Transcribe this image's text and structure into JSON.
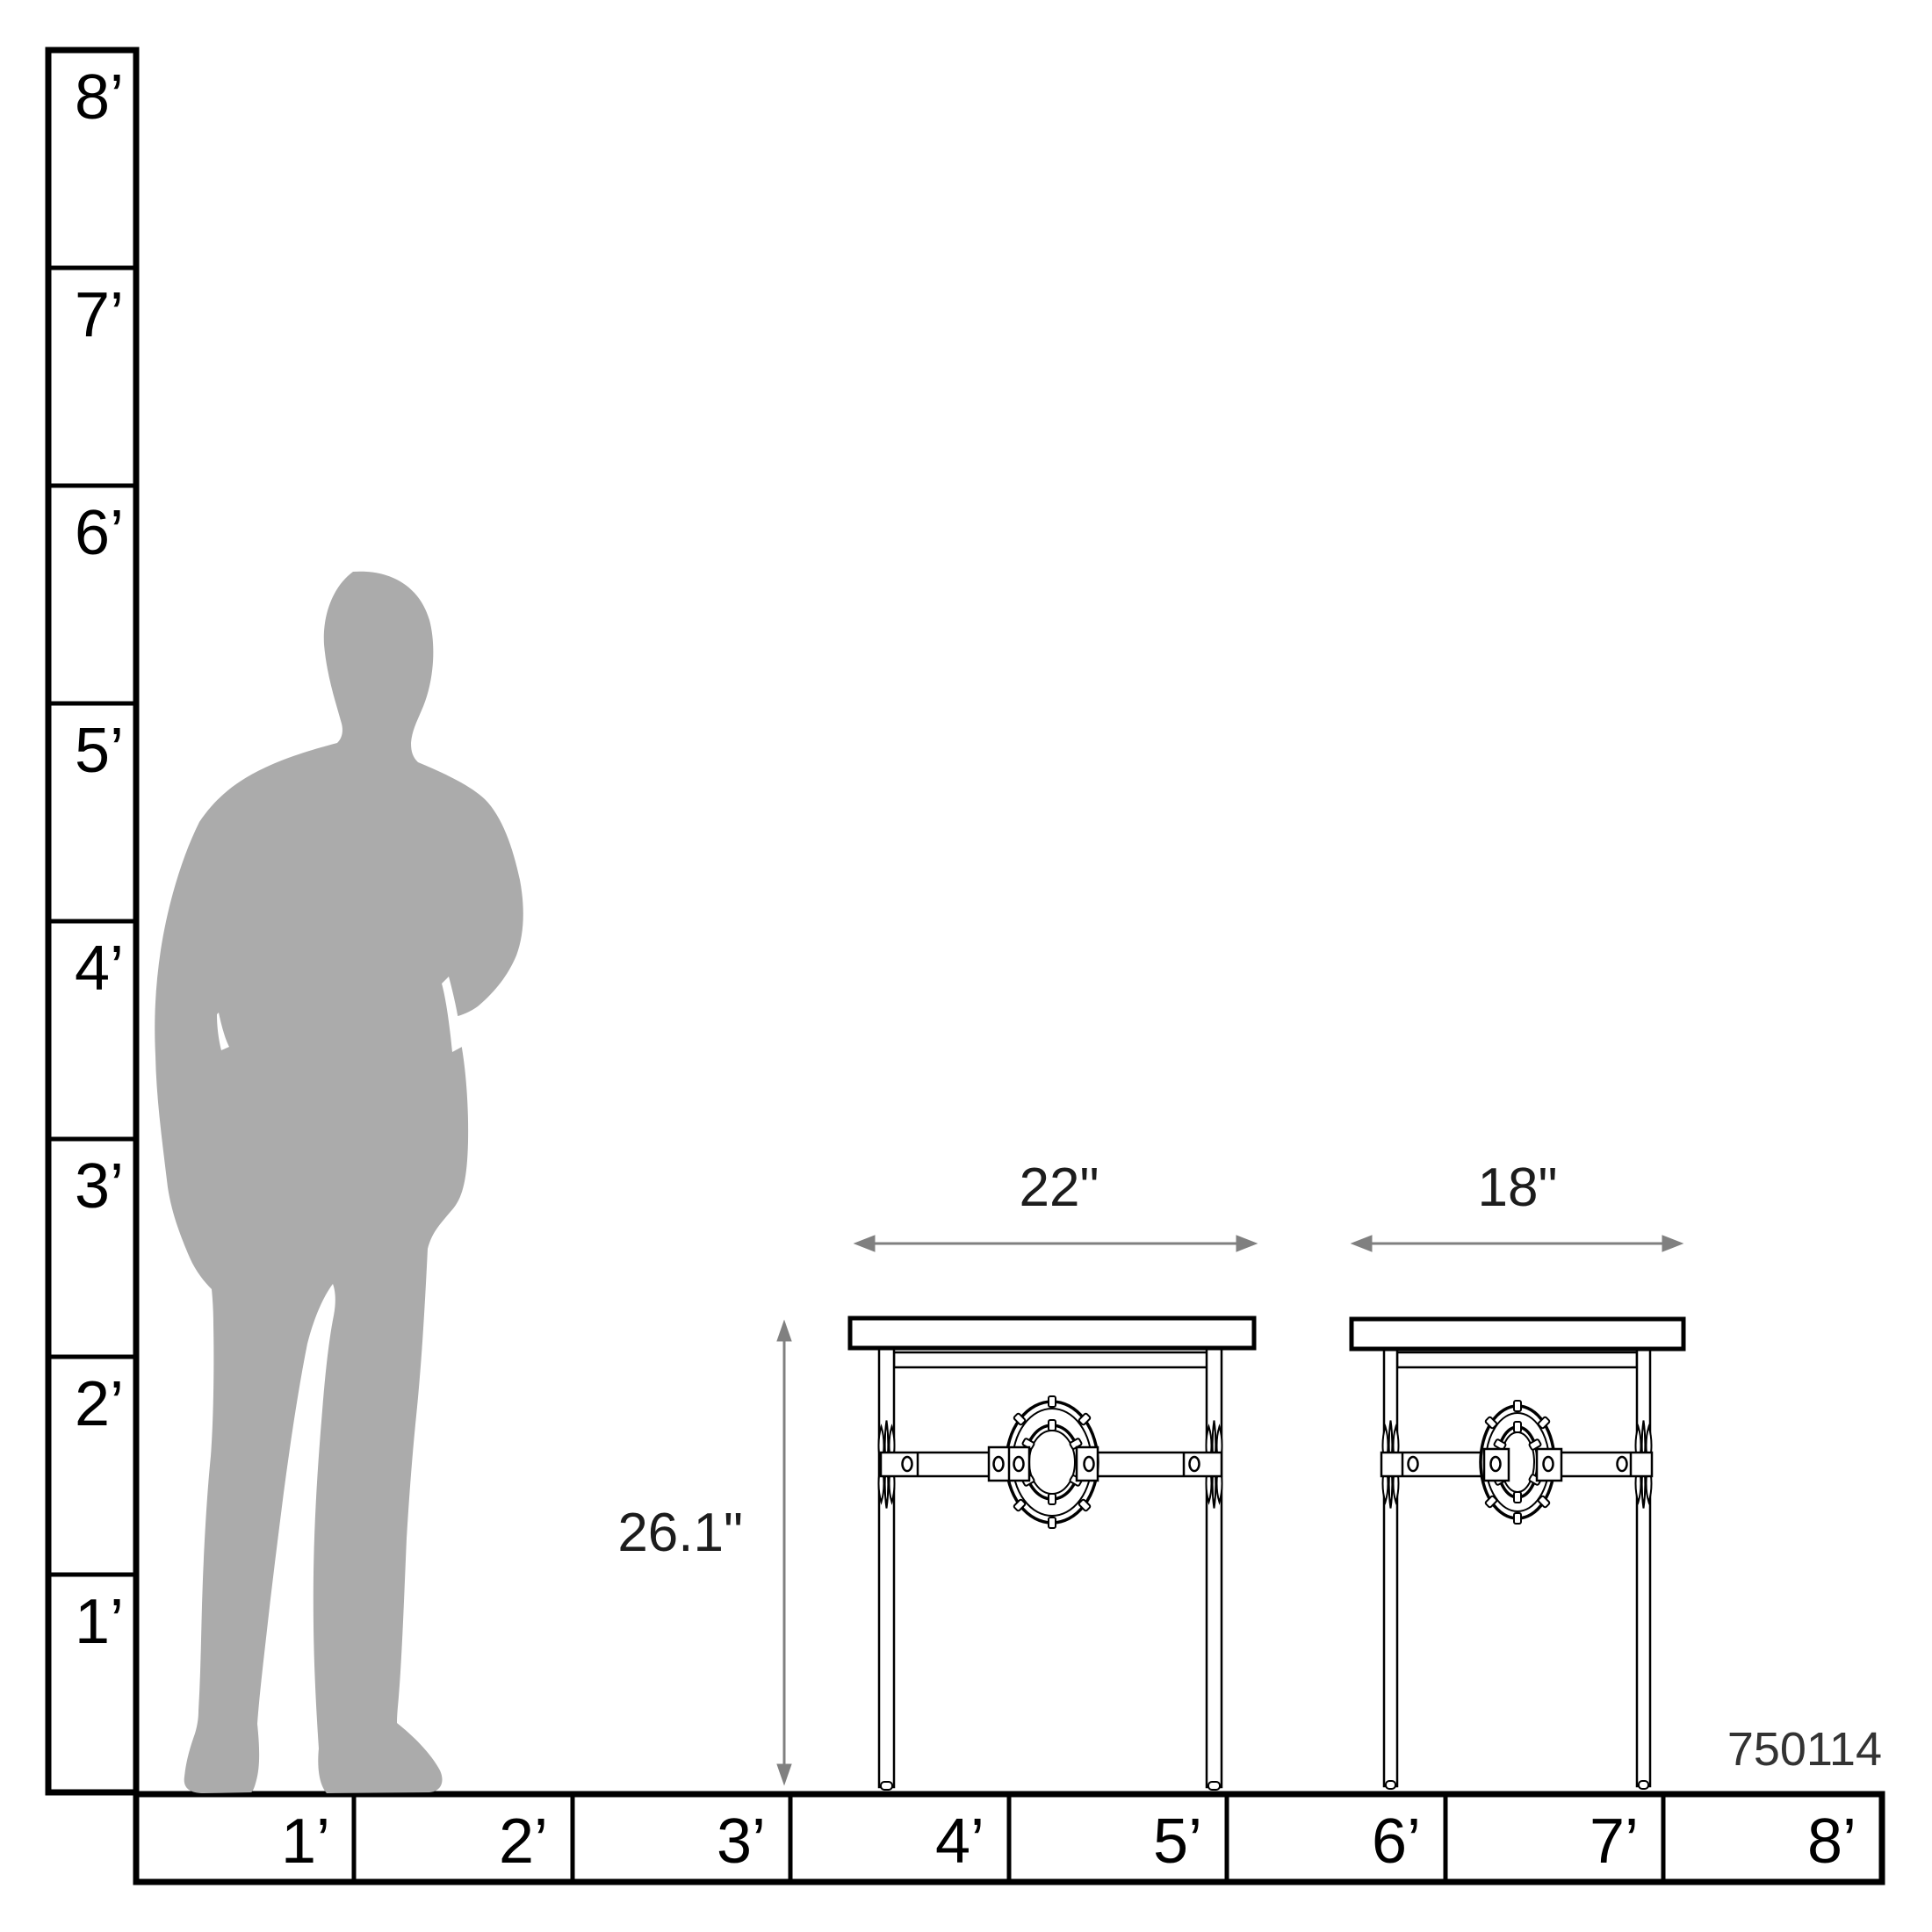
{
  "title": "Furniture scale dimension diagram",
  "colors": {
    "outline": "#000000",
    "dimension_gray": "#808080",
    "silhouette_gray": "#ababab",
    "label_text": "#1c1c1c"
  },
  "rulers": {
    "vertical": {
      "unit": "feet",
      "labels": [
        "8’",
        "7’",
        "6’",
        "5’",
        "4’",
        "3’",
        "2’",
        "1’"
      ]
    },
    "horizontal": {
      "unit": "feet",
      "labels": [
        "1’",
        "2’",
        "3’",
        "4’",
        "5’",
        "6’",
        "7’",
        "8’"
      ]
    }
  },
  "figure": {
    "kind": "standing-man-silhouette"
  },
  "tables": {
    "large": {
      "width_label": "22\"",
      "height_label": "26.1\""
    },
    "small": {
      "width_label": "18\""
    }
  },
  "product": {
    "sku": "750114"
  }
}
